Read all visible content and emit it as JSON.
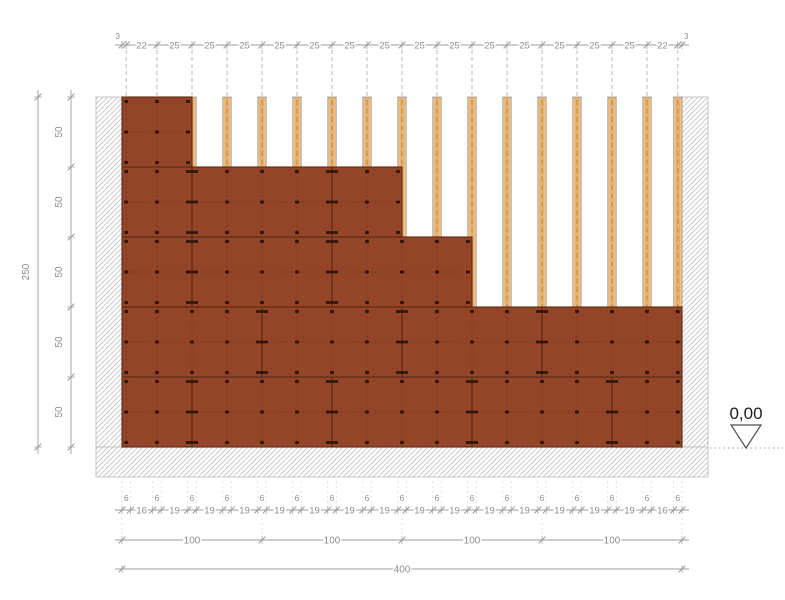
{
  "drawing": {
    "type": "wall-elevation-construction-detail",
    "level_marker": {
      "label": "0,00"
    },
    "dimensions": {
      "top": {
        "values": [
          3,
          22,
          25,
          25,
          25,
          25,
          25,
          25,
          25,
          25,
          25,
          25,
          25,
          25,
          25,
          25,
          22,
          3
        ]
      },
      "left_outer": {
        "total": "250"
      },
      "left_inner": {
        "values": [
          "50",
          "50",
          "50",
          "50",
          "50"
        ]
      },
      "bottom_fine": {
        "values": [
          6,
          16,
          6,
          19,
          6,
          19,
          6,
          19,
          6,
          19,
          6,
          19,
          6,
          19,
          6,
          19,
          6,
          19,
          6,
          19,
          6,
          19,
          6,
          19,
          6,
          19,
          6,
          19,
          6,
          19,
          6,
          16,
          6
        ]
      },
      "bottom_100": {
        "values": [
          "100",
          "100",
          "100",
          "100"
        ]
      },
      "bottom_total": {
        "value": "400"
      }
    },
    "studs": {
      "centers": [
        3,
        25,
        50,
        75,
        100,
        125,
        150,
        175,
        200,
        225,
        250,
        275,
        300,
        325,
        350,
        375,
        397
      ],
      "width": 6
    },
    "courses": [
      {
        "from": 0,
        "to": 50,
        "x_to": 400,
        "joints": [
          50,
          150,
          250,
          350
        ]
      },
      {
        "from": 50,
        "to": 100,
        "x_to": 400,
        "joints": [
          100,
          200,
          300
        ]
      },
      {
        "from": 100,
        "to": 150,
        "x_to": 250,
        "joints": [
          50,
          150
        ]
      },
      {
        "from": 150,
        "to": 200,
        "x_to": 200,
        "joints": [
          50,
          150
        ]
      },
      {
        "from": 200,
        "to": 250,
        "x_to": 50,
        "joints": []
      }
    ],
    "layout": {
      "canvas_w": 785,
      "canvas_h": 600,
      "origin_x": 122,
      "base_y": 447,
      "scale": 1.4,
      "wall_w": 400,
      "wall_h": 250,
      "wall_band_w": 26,
      "footing_bottom": 477,
      "footing_x1": 96,
      "footing_x2": 708,
      "top_chain_y": 45,
      "guide_top_y": 50,
      "fine_chain_y": 510,
      "fine_label_y": 501,
      "chain100_y": 540,
      "chain400_y": 569,
      "left_outer_x": 38,
      "left_inner_x": 71,
      "level_line_y": 448
    },
    "colors": {
      "panel": "#944528",
      "panel_edge": "#5c2a15",
      "panel_dot": "#6e341c",
      "screw": "#2c130a",
      "stud_fill": "#e9b26e",
      "stud_light": "#f3d2a1",
      "stud_edge": "#9b9b9b",
      "stud_dash": "#c08748",
      "hatch_line": "#c6c6c6",
      "hatch_border": "#b9b9b9",
      "dim_line": "#9c9c9c",
      "dim_text": "#8e8e8e",
      "guide_dash": "#b3b3b3",
      "level_text": "#1c1c1c",
      "level_tri": "#4d4d4d"
    }
  }
}
